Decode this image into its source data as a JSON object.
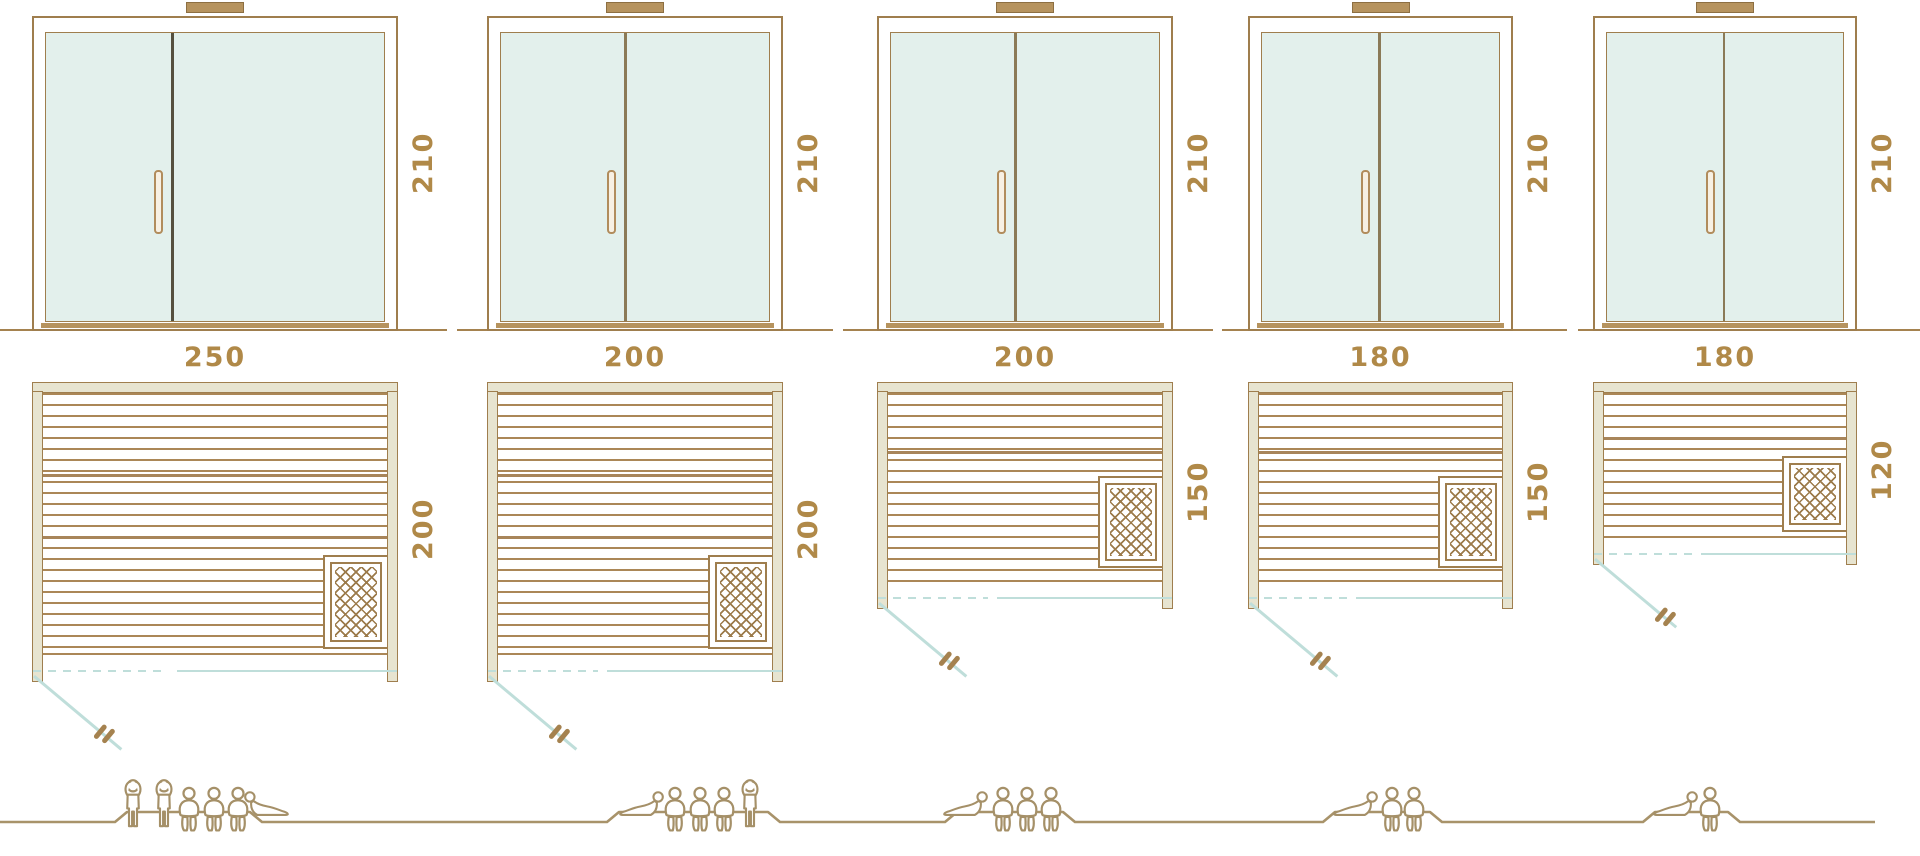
{
  "diagram": "sauna-size-comparison",
  "units": "cm",
  "palette": {
    "line_brown": "#9f7e4e",
    "dimension_text": "#b08948",
    "glass_teal": "#e3f0ec",
    "door_swing_teal": "#bfdeda",
    "wall_fill": "#e7e4d0",
    "figure_outline": "#a59068",
    "threshold_tan": "#b6935e"
  },
  "columns": [
    {
      "name": "sauna-250x200",
      "door_height_label": "210",
      "width_label": "250",
      "depth_label": "200",
      "capacity": 6,
      "people": [
        "standing",
        "standing",
        "seated",
        "seated",
        "seated",
        "lying-left"
      ]
    },
    {
      "name": "sauna-200x200",
      "door_height_label": "210",
      "width_label": "200",
      "depth_label": "200",
      "capacity": 5,
      "people": [
        "lying",
        "seated",
        "seated",
        "seated",
        "standing"
      ]
    },
    {
      "name": "sauna-200x150",
      "door_height_label": "210",
      "width_label": "200",
      "depth_label": "150",
      "capacity": 4,
      "people": [
        "lying",
        "seated",
        "seated",
        "seated"
      ]
    },
    {
      "name": "sauna-180x150",
      "door_height_label": "210",
      "width_label": "180",
      "depth_label": "150",
      "capacity": 3,
      "people": [
        "lying",
        "seated",
        "seated"
      ]
    },
    {
      "name": "sauna-180x120",
      "door_height_label": "210",
      "width_label": "180",
      "depth_label": "120",
      "capacity": 2,
      "people": [
        "lying",
        "seated"
      ]
    }
  ]
}
